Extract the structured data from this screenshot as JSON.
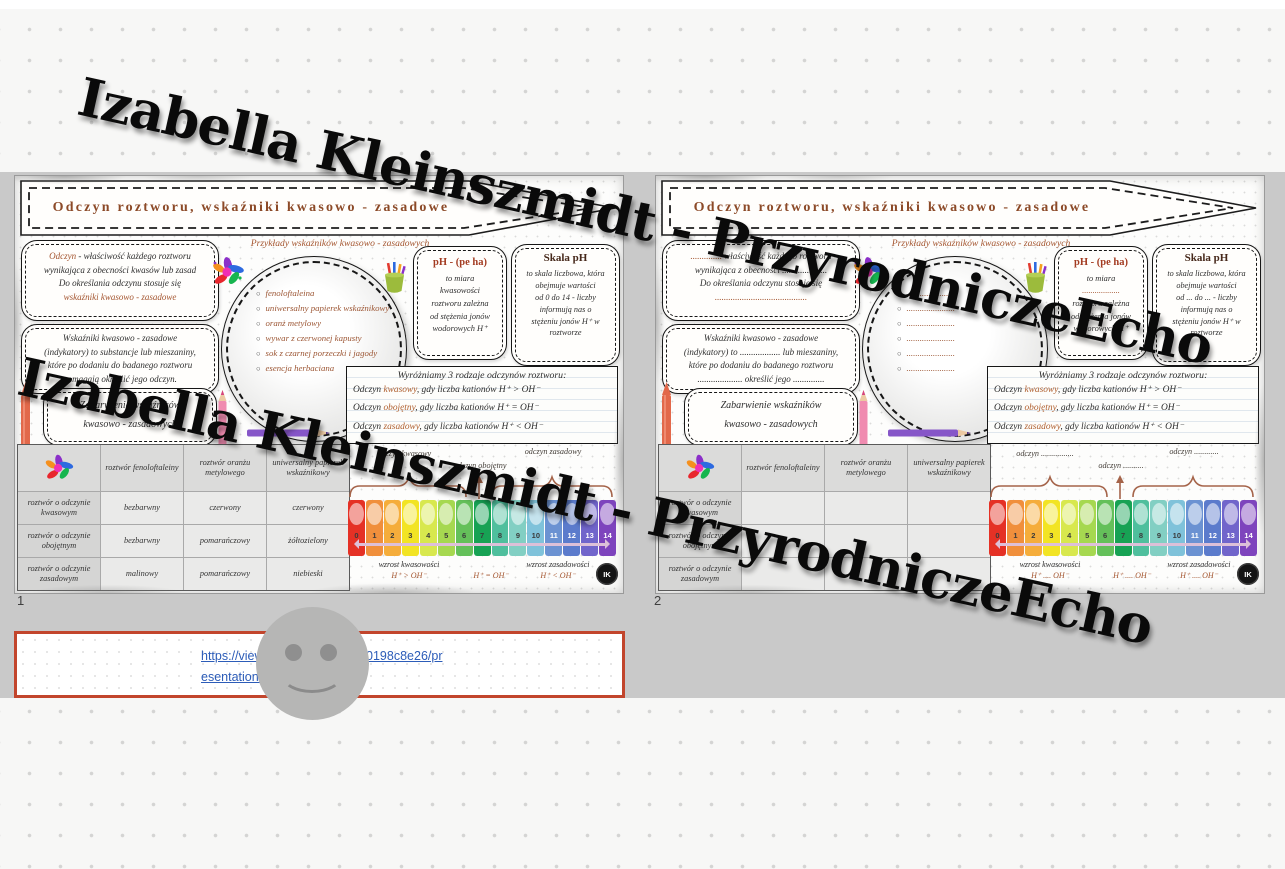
{
  "watermark": {
    "text": "Izabella Kleinszmidt - PrzyrodniczeEcho"
  },
  "page_numbers": {
    "first": "1",
    "second": "2"
  },
  "ph_numbers": [
    "0",
    "1",
    "2",
    "3",
    "4",
    "5",
    "6",
    "7",
    "8",
    "9",
    "10",
    "11",
    "12",
    "13",
    "14"
  ],
  "ph_colors": [
    "#e53125",
    "#f08f3c",
    "#f5ad3b",
    "#f2e424",
    "#d8e84e",
    "#a6d850",
    "#64c05a",
    "#17a254",
    "#4fbf9d",
    "#82cfc3",
    "#7fc2da",
    "#6b92d2",
    "#5b7bcc",
    "#7165cb",
    "#7e44bd"
  ],
  "preview_link": {
    "part1": "https://view.ge",
    "part2": "7b300198c8e26/pr",
    "part3": "esentation-267"
  },
  "slides": [
    {
      "title": "Odczyn roztworu, wskaźniki kwasowo - zasadowe",
      "examples_heading": "Przykłady wskaźników kwasowo - zasadowych",
      "def_box": {
        "lead": "Odczyn",
        "line1rest": " - właściwość każdego roztworu",
        "line2": "wynikająca z obecności kwasów lub zasad",
        "line3": "Do określania odczynu stosuje się",
        "line4": "wskaźniki kwasowo - zasadowe"
      },
      "ind_box": {
        "line1": "Wskaźniki kwasowo - zasadowe",
        "line2": "(indykatory) to substancje lub mieszaniny,",
        "line3": "które po dodaniu do badanego roztworu",
        "line4": "pomagają określić jego odczyn."
      },
      "color_box": {
        "line1": "Zabarwienie wskaźników",
        "line2": "kwasowo - zasadowych"
      },
      "examples": [
        "fenoloftaleina",
        "uniwersalny papierek wskaźnikowy",
        "oranż metylowy",
        "wywar z czerwonej kapusty",
        "sok z czarnej porzeczki i jagody",
        "esencja herbaciana"
      ],
      "ph_box": {
        "title": "pH - (pe ha)",
        "l1": "to miara",
        "l2": "kwasowości",
        "l3": "roztworu zależna",
        "l4": "od stężenia jonów",
        "l5": "wodorowych H⁺"
      },
      "scale_box": {
        "title": "Skala pH",
        "l1": "to skala liczbowa, która",
        "l2": "obejmuje wartości",
        "l3": "od 0 do 14 - liczby",
        "l4": "informują nas o",
        "l5": "stężeniu jonów H⁺ w",
        "l6": "roztworze"
      },
      "types_box": {
        "heading": "Wyróżniamy 3 rodzaje odczynów roztworu:",
        "rows": [
          {
            "pre": "Odczyn ",
            "word": "kwasowy",
            "post": ", gdy liczba kationów H⁺ > OH⁻"
          },
          {
            "pre": "Odczyn ",
            "word": "obojętny",
            "post": ", gdy liczba kationów H⁺ = OH⁻"
          },
          {
            "pre": "Odczyn ",
            "word": "zasadowy",
            "post": ", gdy liczba kationów H⁺ < OH⁻"
          }
        ]
      },
      "table": {
        "headers": [
          "roztwór fenoloftaleiny",
          "roztwór oranżu metylowego",
          "uniwersalny papierek wskaźnikowy"
        ],
        "rows": [
          [
            "roztwór o odczynie kwasowym",
            "bezbarwny",
            "czerwony",
            "czerwony"
          ],
          [
            "roztwór o odczynie obojętnym",
            "bezbarwny",
            "pomarańczowy",
            "żółtozielony"
          ],
          [
            "roztwór o odczynie zasadowym",
            "malinowy",
            "pomarańczowy",
            "niebieski"
          ]
        ]
      },
      "scale_labels": {
        "left": "odczyn kwasowy",
        "mid": "odczyn obojętny",
        "right": "odczyn zasadowy"
      },
      "scale_bottom": {
        "left1": "wzrost kwasowości",
        "left2": "H⁺ > OH⁻",
        "mid": "H⁺ = OH⁻",
        "right1": "wzrost zasadowości",
        "right2": "H⁺ < OH⁻"
      },
      "logo": "IK"
    },
    {
      "title": "Odczyn roztworu, wskaźniki kwasowo - zasadowe",
      "examples_heading": "Przykłady wskaźników kwasowo - zasadowych",
      "def_box": {
        "lead": "..............",
        "line1rest": " właściwość każdego roztworu",
        "line2": "wynikająca z obecności ....................",
        "line3": "Do określania odczynu stosuje się",
        "line4": "........................................."
      },
      "ind_box": {
        "line1": "Wskaźniki kwasowo - zasadowe",
        "line2": "(indykatory) to .................. lub mieszaniny,",
        "line3": "które po dodaniu do badanego roztworu",
        "line4": ".................... określić jego .............."
      },
      "color_box": {
        "line1": "Zabarwienie wskaźników",
        "line2": "kwasowo - zasadowych"
      },
      "examples": [
        "......................",
        "......................",
        "......................",
        "......................",
        "......................",
        "......................"
      ],
      "ph_box": {
        "title": "pH - (pe ha)",
        "l1": "to miara",
        "l2": "..................",
        "l3": "roztworu zależna",
        "l4": "od stężenia jonów",
        "l5": "wodorowych H⁺"
      },
      "scale_box": {
        "title": "Skala pH",
        "l1": "to skala liczbowa, która",
        "l2": "obejmuje wartości",
        "l3": "od ... do ... - liczby",
        "l4": "informują nas o",
        "l5": "stężeniu jonów H⁺ w",
        "l6": "roztworze"
      },
      "types_box": {
        "heading": "Wyróżniamy 3 rodzaje odczynów roztworu:",
        "rows": [
          {
            "pre": "Odczyn ",
            "word": "kwasowy",
            "post": ", gdy liczba kationów H⁺ > OH⁻"
          },
          {
            "pre": "Odczyn ",
            "word": "obojętny",
            "post": ", gdy liczba kationów H⁺ = OH⁻"
          },
          {
            "pre": "Odczyn ",
            "word": "zasadowy",
            "post": ", gdy liczba kationów H⁺ < OH⁻"
          }
        ]
      },
      "table": {
        "headers": [
          "roztwór fenoloftaleiny",
          "roztwór oranżu metylowego",
          "uniwersalny papierek wskaźnikowy"
        ],
        "rows": [
          [
            "roztwór o odczynie kwasowym",
            "",
            "",
            ""
          ],
          [
            "roztwór o odczynie obojętnym",
            "",
            "",
            ""
          ],
          [
            "roztwór o odczynie zasadowym",
            "",
            "",
            ""
          ]
        ]
      },
      "scale_labels": {
        "left": "odczyn ................",
        "mid": "odczyn ..........",
        "right": "odczyn ............"
      },
      "scale_bottom": {
        "left1": "wzrost kwasowości",
        "left2": "H⁺ .... OH⁻",
        "mid": "H⁺ .... OH⁻",
        "right1": "wzrost zasadowości",
        "right2": "H⁺ .... OH⁻"
      },
      "logo": "IK"
    }
  ]
}
